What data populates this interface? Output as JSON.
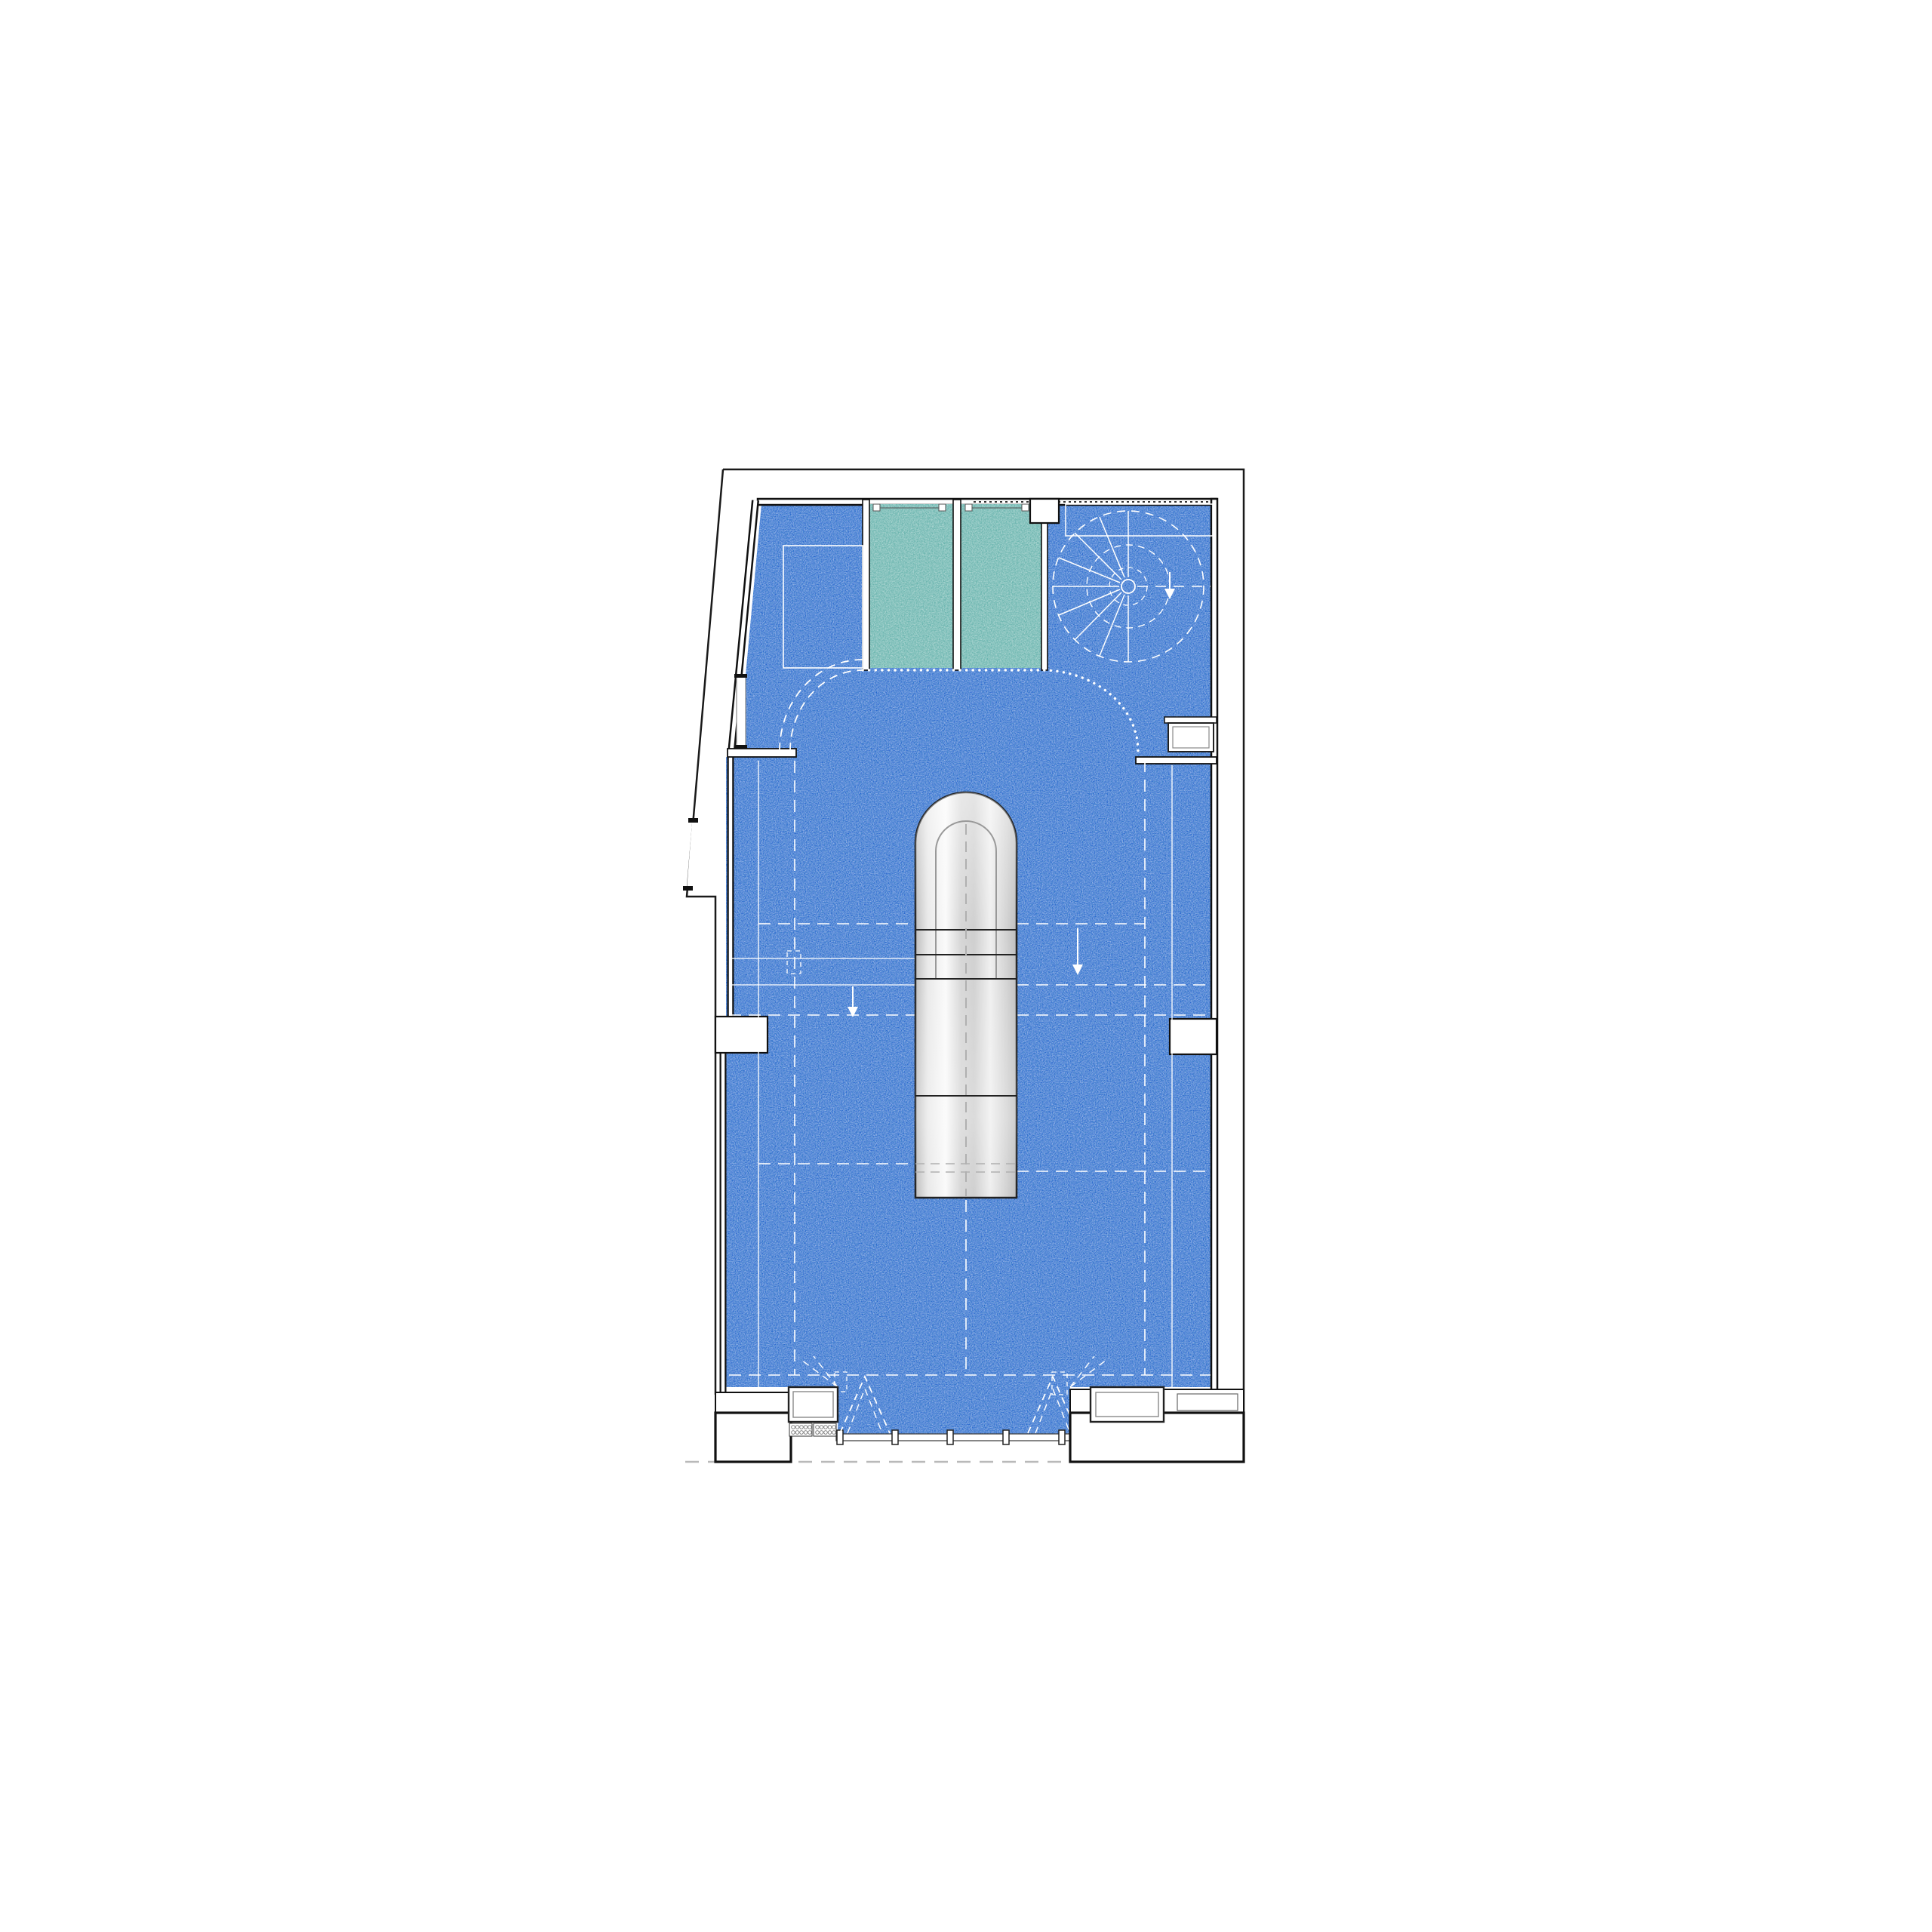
{
  "page": {
    "background": "#ffffff",
    "description": "Architectural floor plan drawing: retail space with blue carpet, two teal fitting rooms, spiral staircase, curved curtain track, central metallic stair capsule and glazed storefront entrance"
  },
  "colors": {
    "page_bg": "#ffffff",
    "carpet": "#2161cd",
    "carpet_dark_speckle": "#0a3a8f",
    "teal": "#6ab5ae",
    "teal_dark_speckle": "#1f6e66",
    "wall_black": "#111111",
    "outline_black": "#1a1a1a",
    "line_white": "#ffffff",
    "frame_gray": "#888888",
    "detail_gray": "#444444",
    "canopy_gray": "#b9b9b9",
    "steel_edge": "#bdbdbd",
    "steel_mid": "#d6d6d6",
    "steel_highlight": "#fafafa",
    "capsule_line_gray": "#999999"
  },
  "plan": {
    "type": "architectural-floor-plan",
    "features": {
      "fitting_rooms": 2,
      "spiral_staircase": 1,
      "central_stair_capsule": 1,
      "curtain_track": 1,
      "storefront_mullions": 5,
      "entrance_door_swings": 2,
      "display_cases": 2,
      "floor_grilles": 2,
      "wall_niches": 2,
      "left_wall_window": 1
    }
  }
}
